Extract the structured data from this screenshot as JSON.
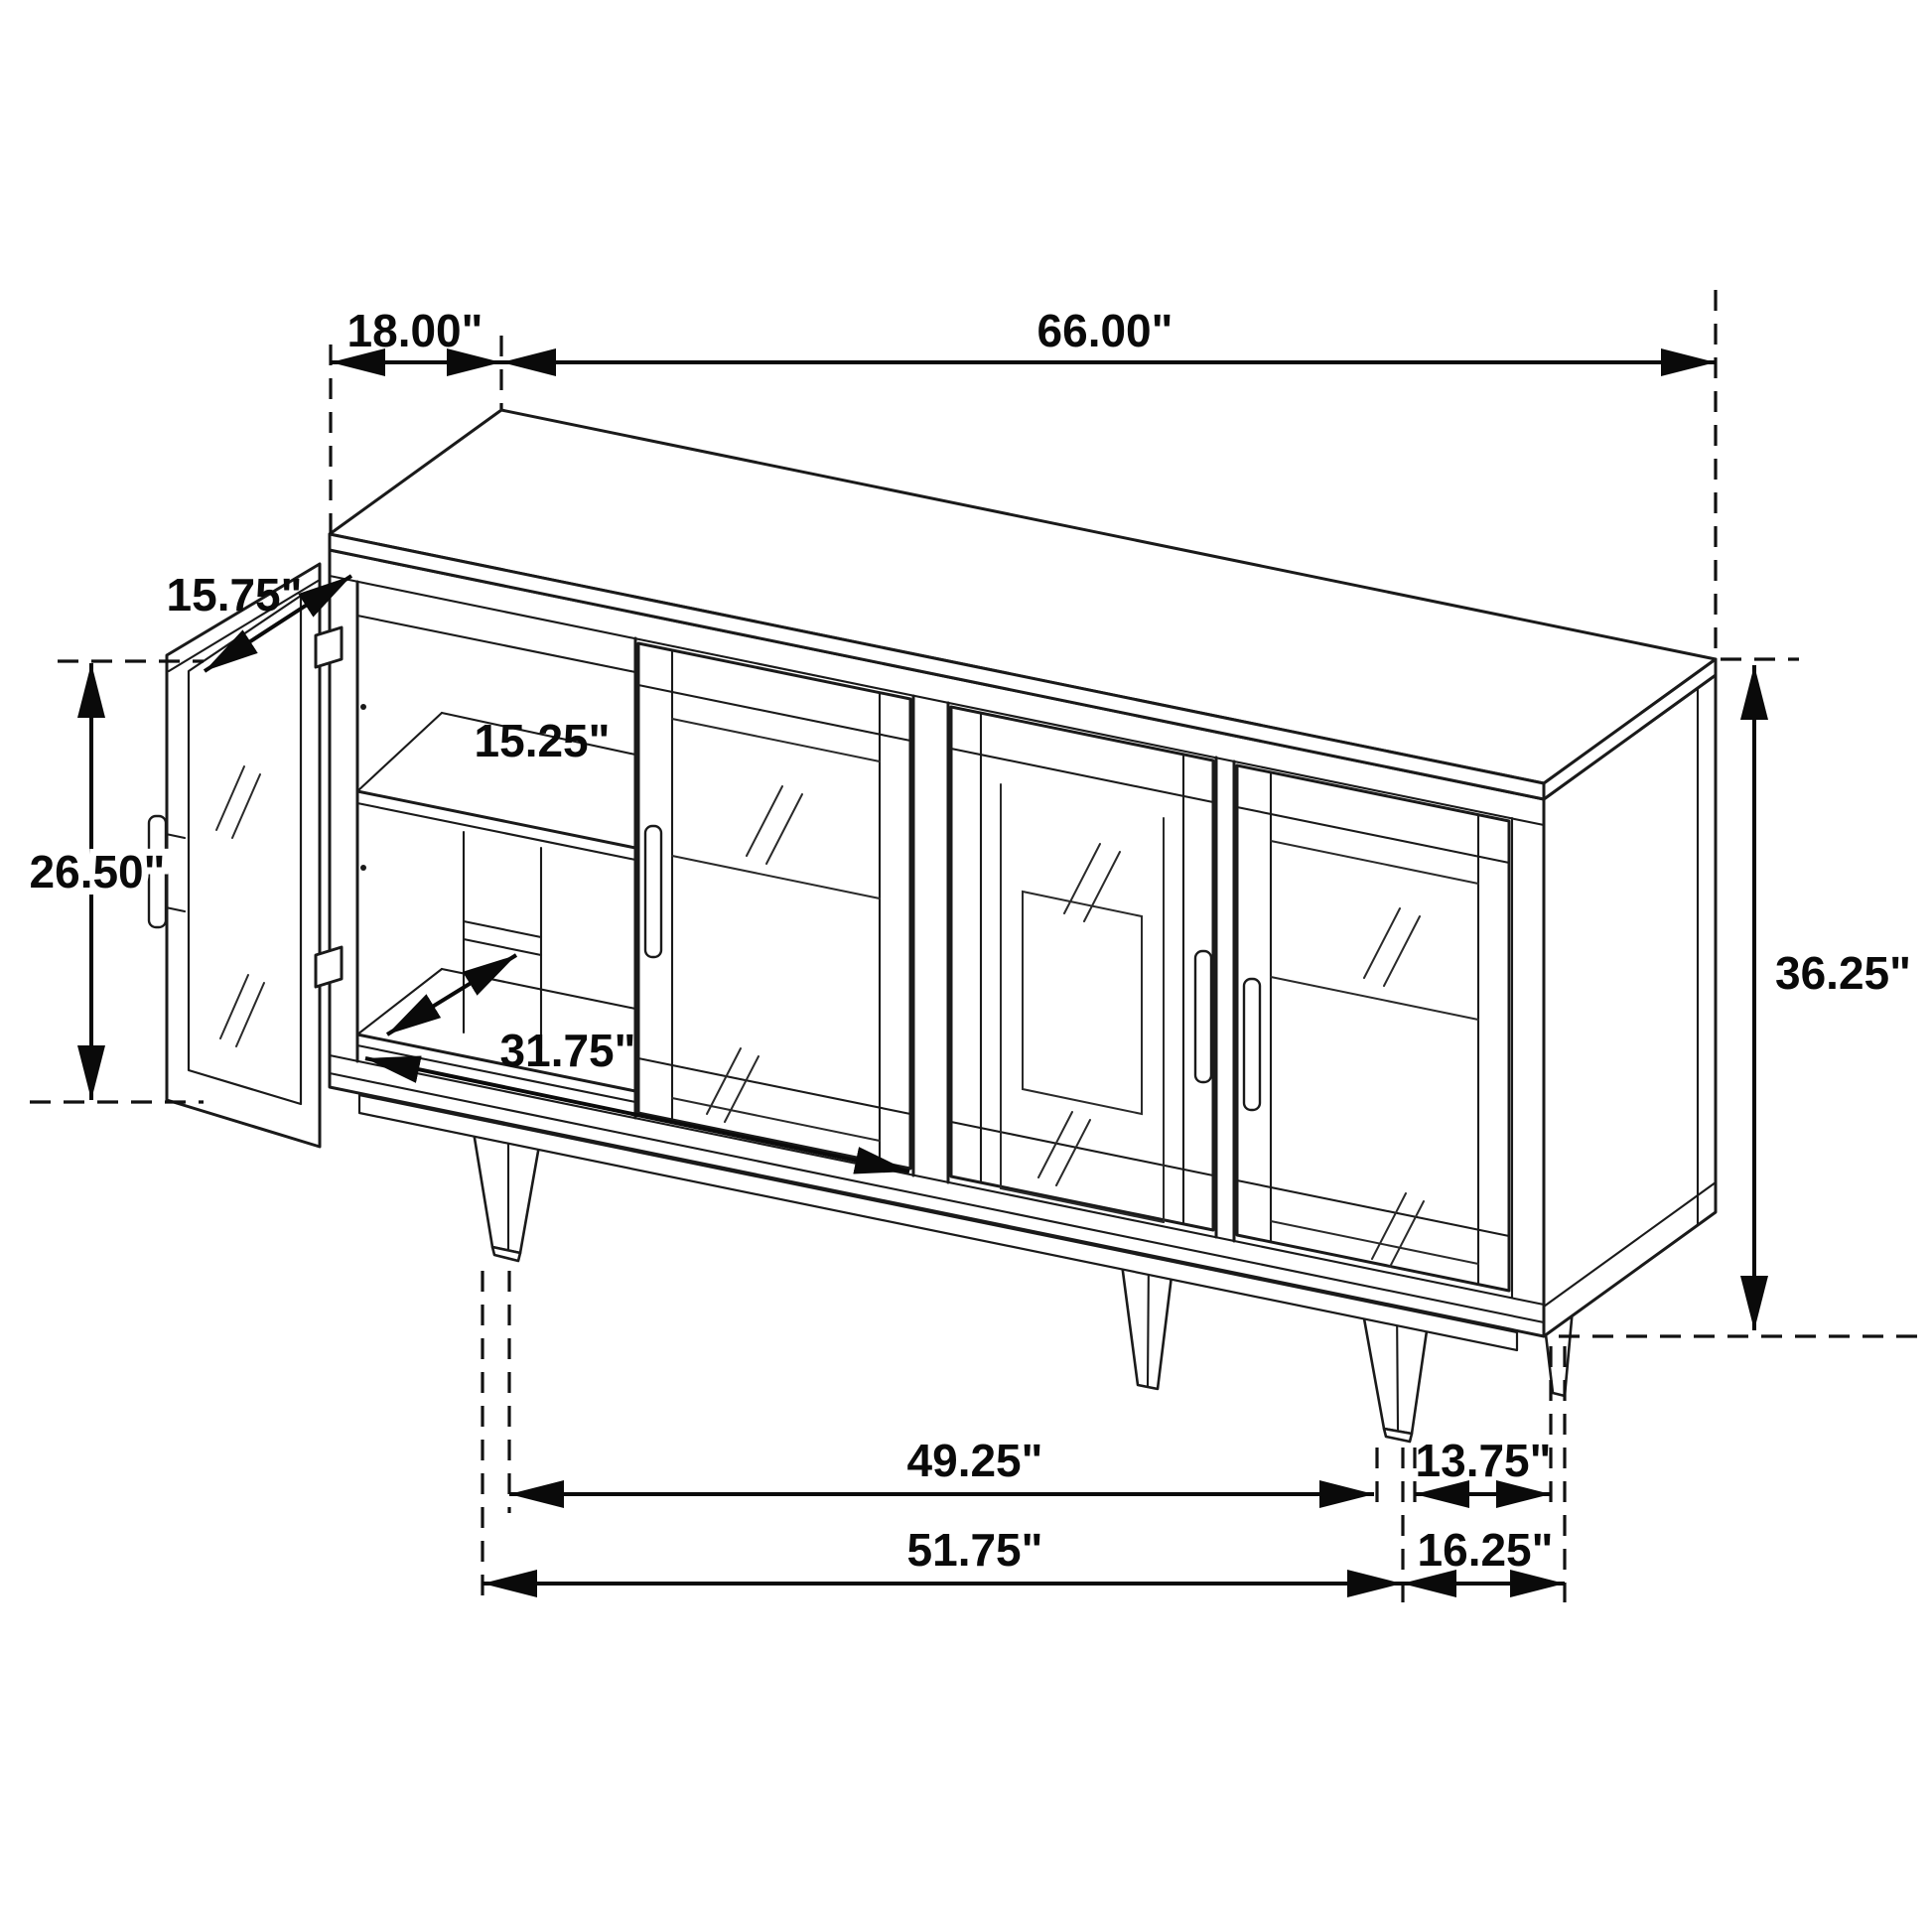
{
  "diagram": {
    "kind": "furniture dimension line drawing",
    "labels": {
      "top_depth": "18.00\"",
      "overall_width": "66.00\"",
      "door_width": "15.75\"",
      "door_height": "26.50\"",
      "shelf_width": "15.25\"",
      "interior_width": "31.75\"",
      "overall_height": "36.25\"",
      "front_span_inner": "49.25\"",
      "front_span_outer": "51.75\"",
      "side_span_inner": "13.75\"",
      "side_span_outer": "16.25\""
    }
  }
}
